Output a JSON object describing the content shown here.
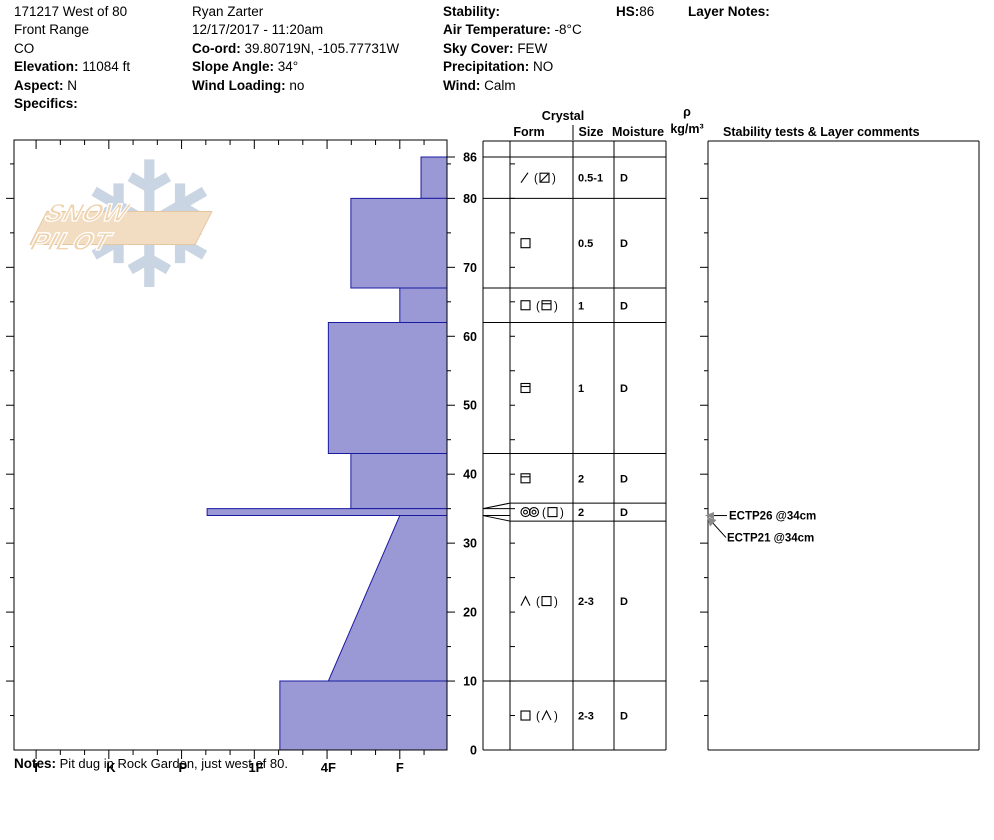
{
  "header": {
    "col1": {
      "title": "171217 West of 80",
      "range": "Front Range",
      "state": "CO",
      "elevation_label": "Elevation:",
      "elevation_value": "11084 ft",
      "aspect_label": "Aspect:",
      "aspect_value": "N",
      "specifics_label": "Specifics:"
    },
    "col2": {
      "observer": "Ryan Zarter",
      "datetime": "12/17/2017 - 11:20am",
      "coord_label": "Co-ord:",
      "coord_value": "39.80719N, -105.77731W",
      "slope_label": "Slope Angle:",
      "slope_value": "34°",
      "wind_loading_label": "Wind Loading:",
      "wind_loading_value": "no"
    },
    "col3": {
      "stability_label": "Stability:",
      "air_temp_label": "Air Temperature:",
      "air_temp_value": "-8°C",
      "sky_label": "Sky Cover:",
      "sky_value": "FEW",
      "precip_label": "Precipitation:",
      "precip_value": "NO",
      "wind_label": "Wind:",
      "wind_value": "Calm"
    },
    "hs_label": "HS:",
    "hs_value": "86",
    "layer_notes_label": "Layer Notes:"
  },
  "logo": {
    "text": "SNOW PILOT",
    "snowflake_icon": "snowflake-icon",
    "band_color": "#f2dcc2",
    "flake_color": "#c9d5e3"
  },
  "notes": {
    "label": "Notes:",
    "text": "Pit dug in Rock Garden, just west of 80."
  },
  "chart_data": {
    "type": "bar",
    "subtype": "snow-hardness-profile",
    "depth_unit": "cm",
    "total_depth": 86,
    "depth_ticks": [
      86,
      80,
      70,
      60,
      50,
      40,
      30,
      20,
      10,
      0
    ],
    "hardness_categories": [
      "I",
      "K",
      "P",
      "1F",
      "4F",
      "F"
    ],
    "hardness_axis_fractions": {
      "I": 0.051,
      "K": 0.224,
      "P": 0.39,
      "1F": 0.559,
      "4F": 0.726,
      "F": 0.891,
      "F-": 0.94,
      "4F+": 0.778,
      "P+": 0.446,
      "1F+": 0.614
    },
    "bar_fill": "#9a99d6",
    "bar_stroke": "#1a1aa0",
    "layers": [
      {
        "top": 86,
        "bottom": 80,
        "hardness": "F-",
        "form_tokens": [
          "slash",
          "sp",
          "po",
          "sqslash",
          "pc"
        ],
        "size": "0.5-1",
        "moisture": "D"
      },
      {
        "top": 80,
        "bottom": 67,
        "hardness": "4F+",
        "form_tokens": [
          "sq"
        ],
        "size": "0.5",
        "moisture": "D"
      },
      {
        "top": 67,
        "bottom": 62,
        "hardness": "F",
        "form_tokens": [
          "sq",
          "sp",
          "po",
          "sqline",
          "pc"
        ],
        "size": "1",
        "moisture": "D"
      },
      {
        "top": 62,
        "bottom": 43,
        "hardness": "4F",
        "form_tokens": [
          "sqline"
        ],
        "size": "1",
        "moisture": "D"
      },
      {
        "top": 43,
        "bottom": 35,
        "hardness": "4F+",
        "form_tokens": [
          "sqline"
        ],
        "size": "2",
        "moisture": "D"
      },
      {
        "top": 35,
        "bottom": 34,
        "hardness": "P+",
        "form_tokens": [
          "dbl",
          "dbl",
          "sp",
          "po",
          "sq",
          "pc"
        ],
        "size": "2",
        "moisture": "D"
      },
      {
        "top": 34,
        "bottom": 10,
        "hardness": "F",
        "hardness_bottom": "4F",
        "form_tokens": [
          "hoar",
          "sp",
          "po",
          "sq",
          "pc"
        ],
        "size": "2-3",
        "moisture": "D"
      },
      {
        "top": 10,
        "bottom": 0,
        "hardness": "1F+",
        "form_tokens": [
          "sq",
          "sp",
          "po",
          "hoar",
          "pc"
        ],
        "size": "2-3",
        "moisture": "D"
      }
    ],
    "table": {
      "crystal_label": "Crystal",
      "form_label": "Form",
      "size_label": "Size",
      "moisture_label": "Moisture",
      "density_label_top": "ρ",
      "density_label_bottom": "kg/m³",
      "comments_label": "Stability tests & Layer comments"
    },
    "stability_tests": [
      {
        "text": "ECTP26 @34cm",
        "depth": 34
      },
      {
        "text": "ECTP21 @34cm",
        "depth": 34
      }
    ]
  }
}
